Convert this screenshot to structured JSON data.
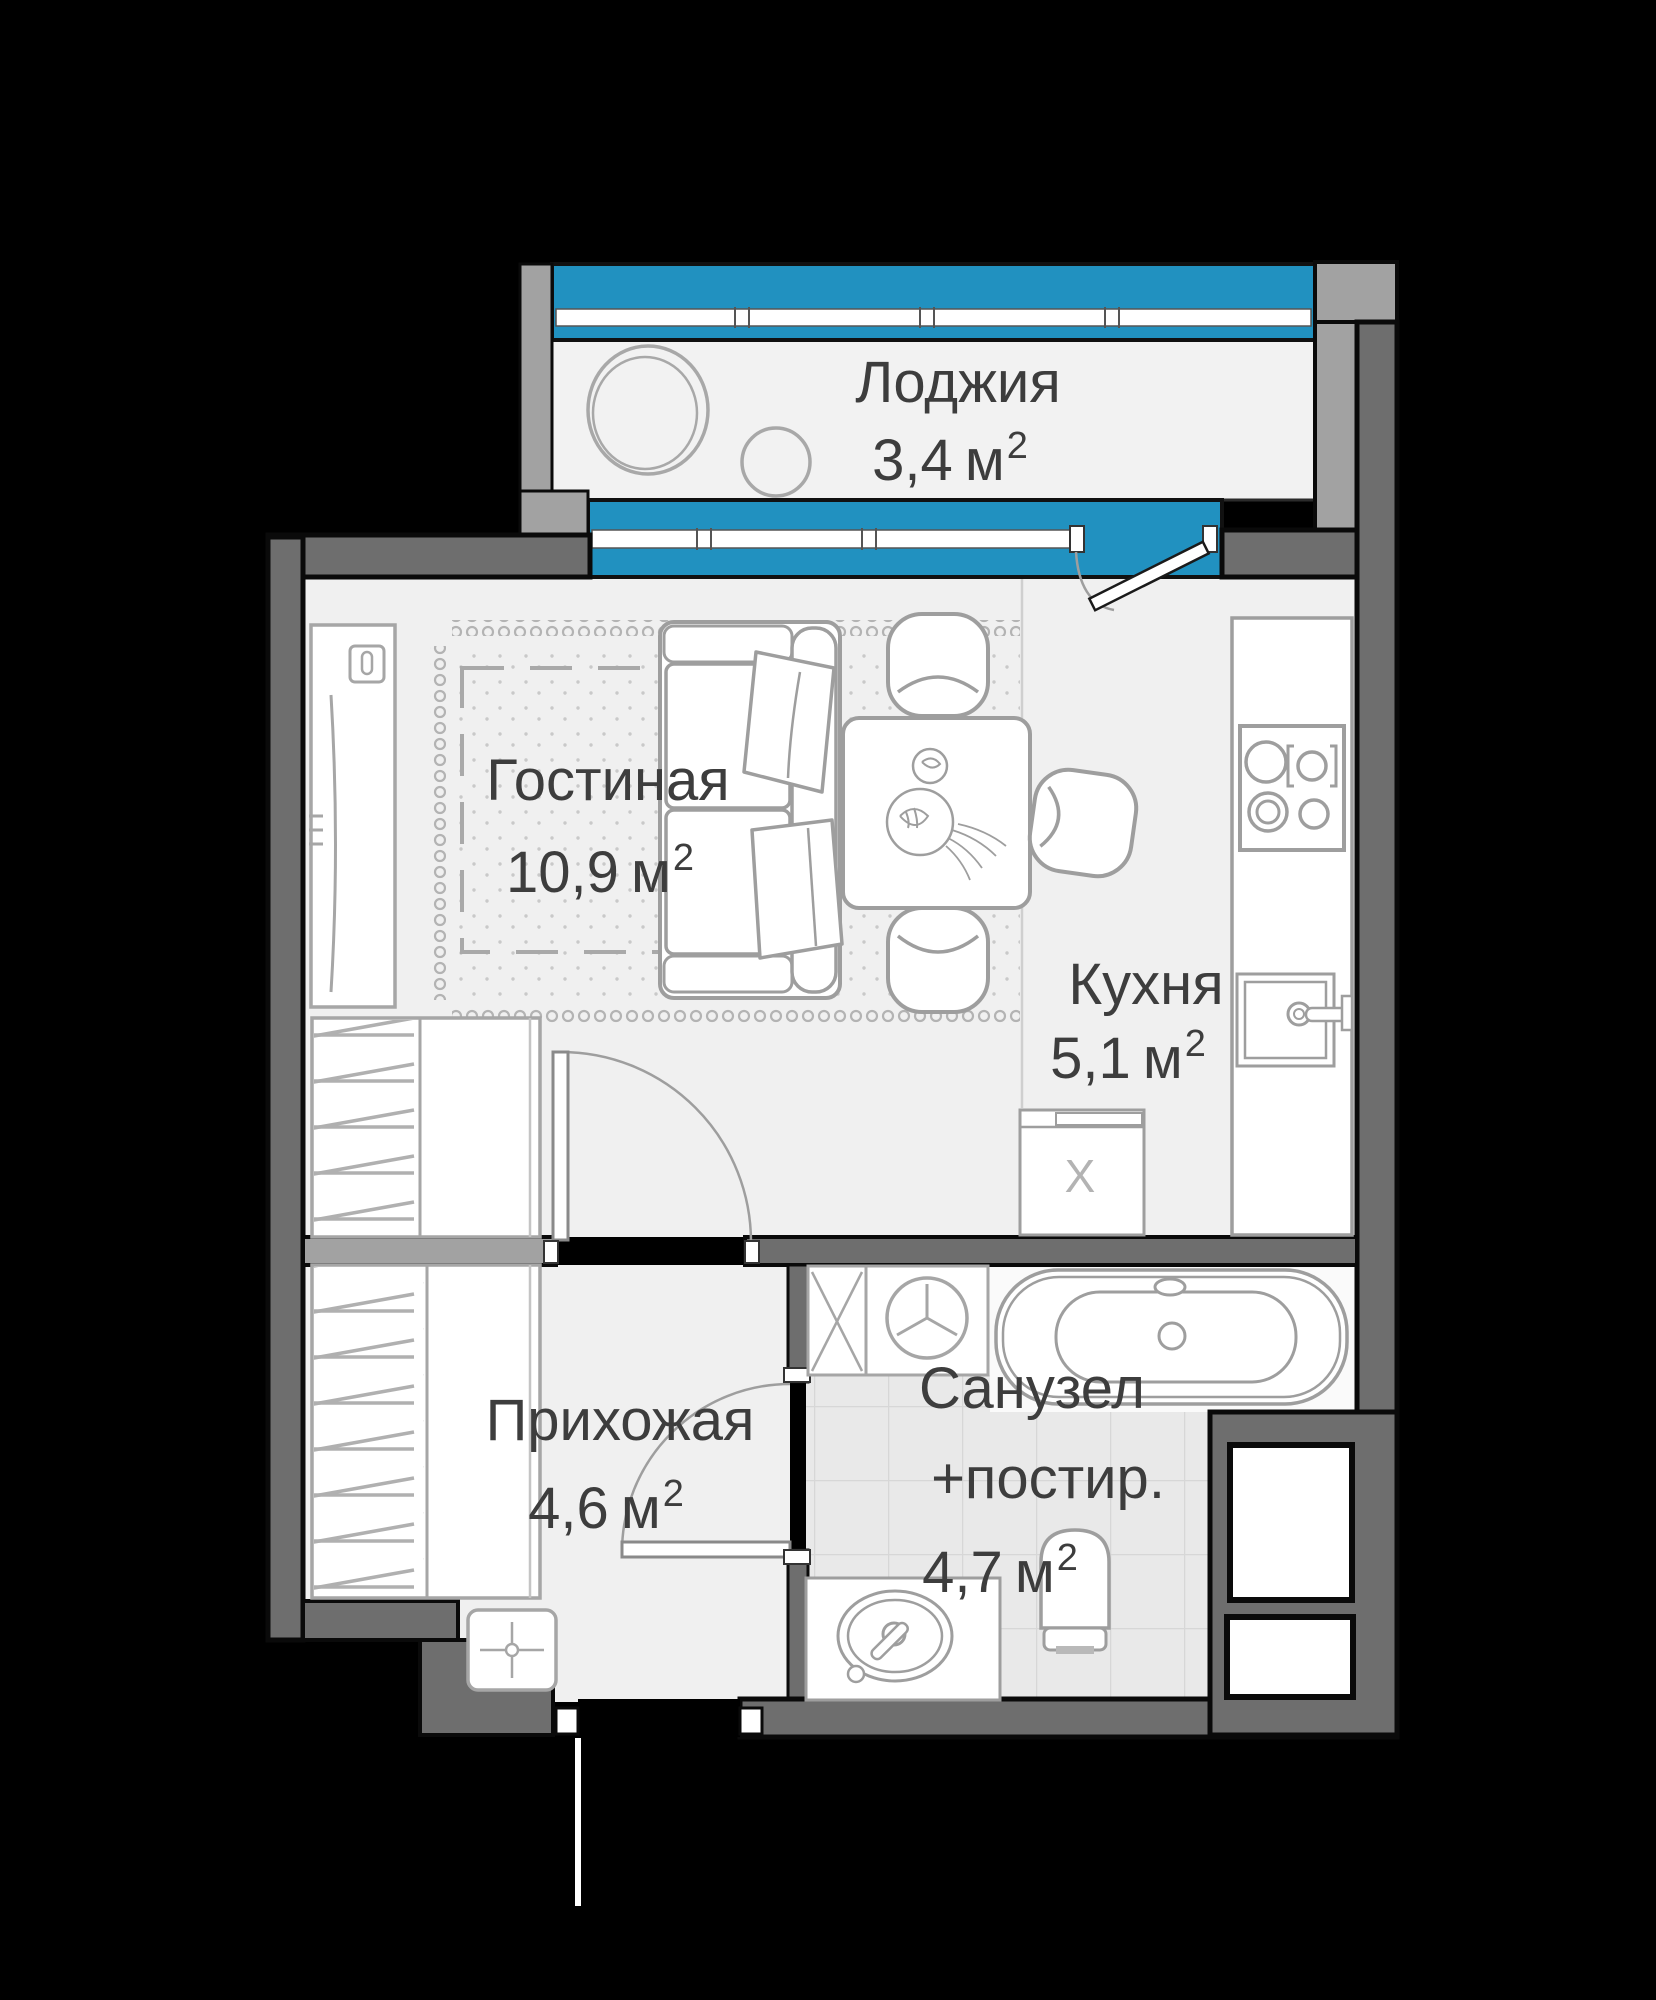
{
  "canvas": {
    "width": 1656,
    "height": 2000
  },
  "colors": {
    "background": "#000000",
    "floor": "#f0f0f0",
    "tile_floor": "#e9e9e9",
    "wall_dark": "#6e6e6e",
    "wall_light": "#a2a2a2",
    "window_blue": "#2191c0",
    "furniture_line": "#9e9e9e",
    "label_text": "#3d3d3d"
  },
  "rooms": [
    {
      "id": "loggia",
      "label": "Лоджия",
      "area": "3,4"
    },
    {
      "id": "living",
      "label": "Гостиная",
      "area": "10,9"
    },
    {
      "id": "kitchen",
      "label": "Кухня",
      "area": "5,1"
    },
    {
      "id": "hallway",
      "label": "Прихожая",
      "area": "4,6"
    },
    {
      "id": "bathroom",
      "label": "Санузел",
      "label_extra": "+постир.",
      "area": "4,7"
    }
  ],
  "units": {
    "meter": "м",
    "sup": "2"
  },
  "marks": {
    "appliance": "X"
  }
}
